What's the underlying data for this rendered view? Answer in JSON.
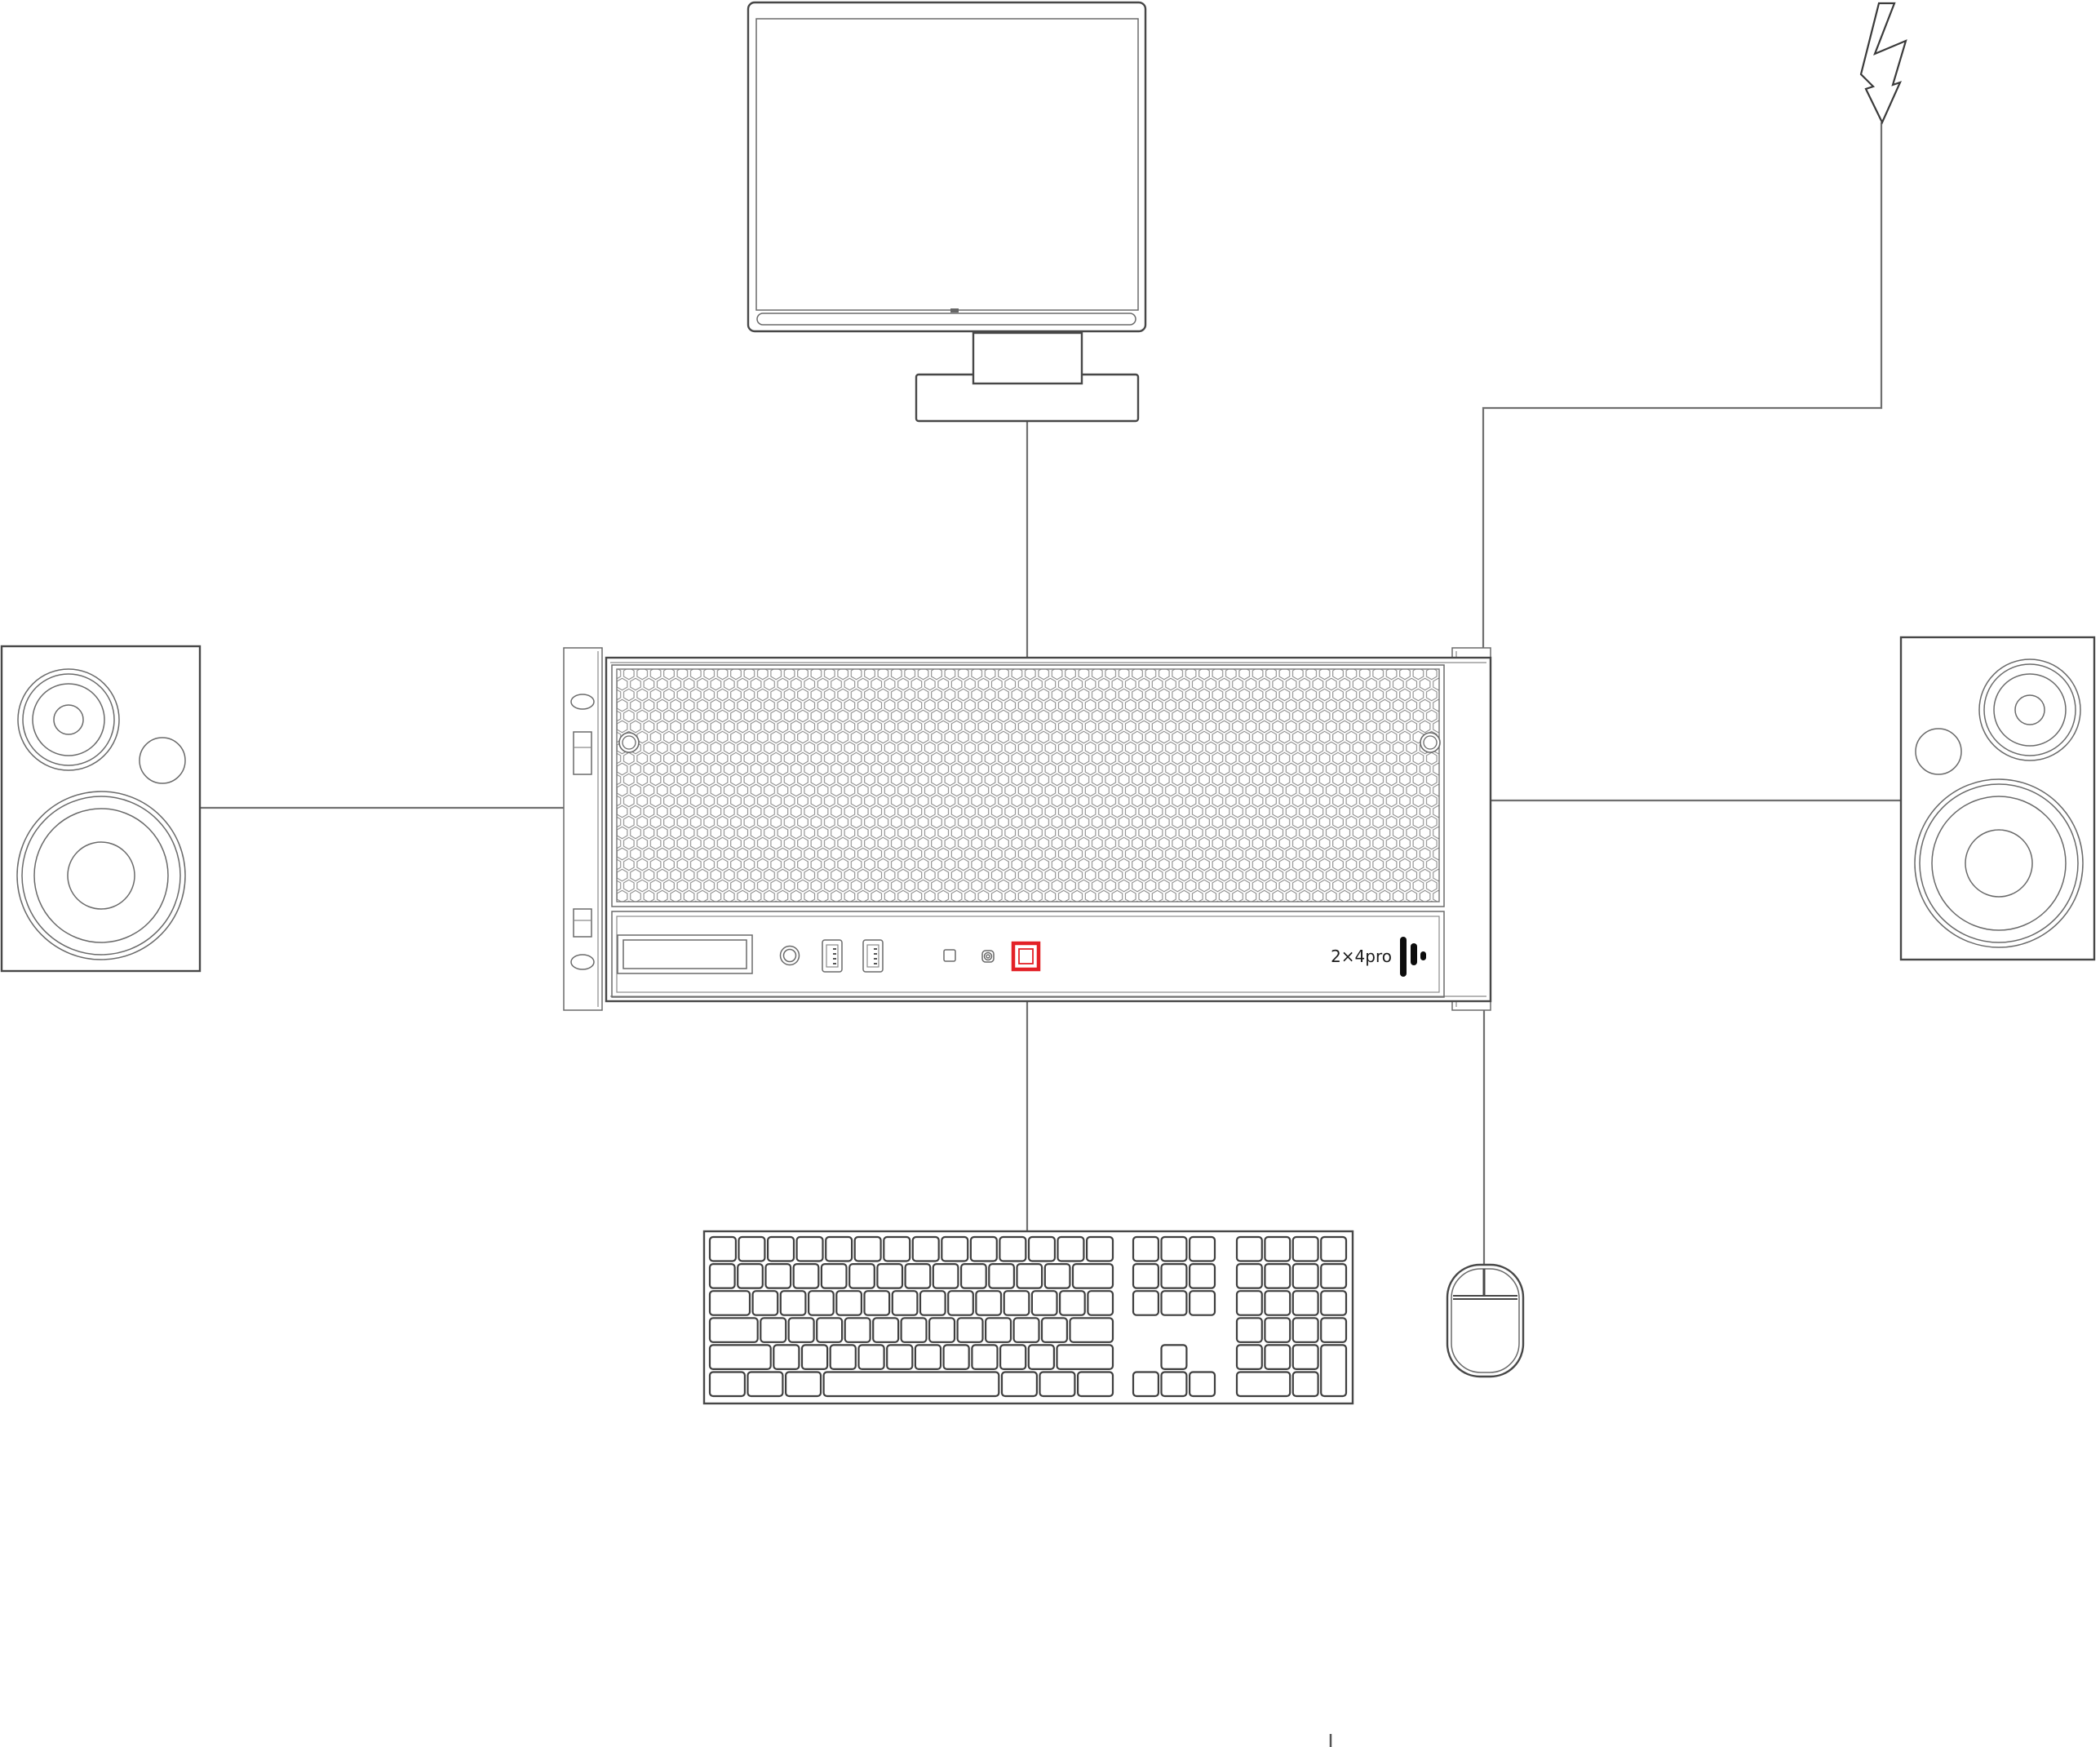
{
  "server": {
    "brand_label": "2×4pro",
    "accent_color": "#e32127",
    "front_panel_items": [
      "display-bay",
      "headphone-jack",
      "usb-port-1",
      "usb-port-2",
      "status-led",
      "reset-button",
      "power-button"
    ],
    "logo": "audio-bars-icon"
  },
  "devices": [
    "monitor",
    "power-input",
    "rack-server",
    "left-speaker",
    "right-speaker",
    "keyboard",
    "mouse"
  ],
  "connections": [
    {
      "from": "monitor",
      "to": "rack-server"
    },
    {
      "from": "power-input",
      "to": "rack-server"
    },
    {
      "from": "left-speaker",
      "to": "rack-server"
    },
    {
      "from": "rack-server",
      "to": "right-speaker"
    },
    {
      "from": "rack-server",
      "to": "keyboard"
    },
    {
      "from": "rack-server",
      "to": "mouse"
    }
  ],
  "colors": {
    "cable": "#6f6f6f",
    "outline": "#474747",
    "grille": "#8c8c8c",
    "accent": "#e32127"
  },
  "keyboard_layout": {
    "main_rows": [
      [
        1,
        1,
        1,
        1,
        1,
        1,
        1,
        1,
        1,
        1,
        1,
        1,
        1,
        1
      ],
      [
        1,
        1,
        1,
        1,
        1,
        1,
        1,
        1,
        1,
        1,
        1,
        1,
        1,
        1.6
      ],
      [
        1.6,
        1,
        1,
        1,
        1,
        1,
        1,
        1,
        1,
        1,
        1,
        1,
        1,
        1
      ],
      [
        1.9,
        1,
        1,
        1,
        1,
        1,
        1,
        1,
        1,
        1,
        1,
        1,
        1.7
      ],
      [
        2.4,
        1,
        1,
        1,
        1,
        1,
        1,
        1,
        1,
        1,
        1,
        2.2
      ],
      [
        1.3,
        1.3,
        1.3,
        6.5,
        1.3,
        1.3,
        1.3
      ]
    ]
  }
}
